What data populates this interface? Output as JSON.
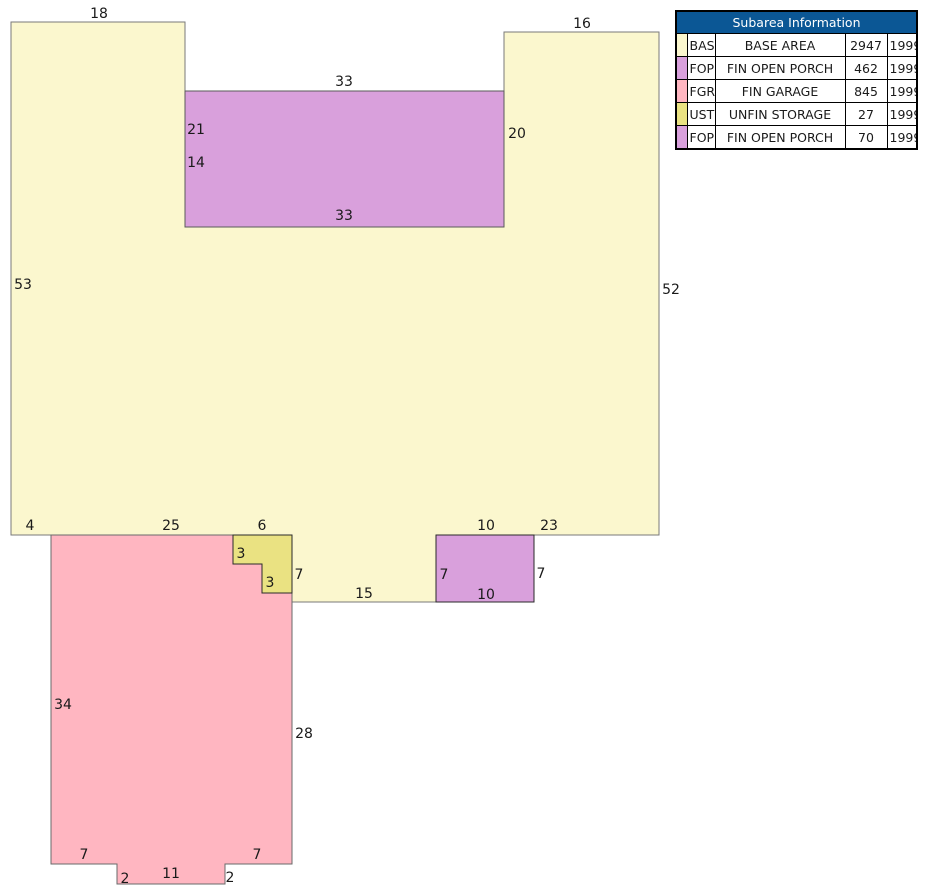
{
  "colors": {
    "background": "#ffffff",
    "table_header_bg": "#0B5795",
    "table_header_text": "#ffffff",
    "base_area_fill": "#FBF7CE",
    "fin_open_porch_fill": "#D9A0DC",
    "fin_garage_fill": "#FFB6C1",
    "unfin_storage_fill": "#EAE282",
    "outline_light": "#7a7a7a",
    "outline_dark": "#2a2a2a",
    "label_text": "#1a1a1a"
  },
  "sketch": {
    "areas": [
      {
        "name": "base-area",
        "code": "BAS",
        "color": "#FBF7CE",
        "stroke": "#7a7a7a",
        "path": "M11,22 L185,22 L185,227 L504,227 L504,32 L659,32 L659,535 L436,535 L436,602 L292,602 L292,535 L11,535 Z"
      },
      {
        "name": "fin-open-porch-462",
        "code": "FOP",
        "color": "#D9A0DC",
        "stroke": "#5a5a5a",
        "path": "M185,91 L504,91 L504,227 L185,227 Z"
      },
      {
        "name": "fin-garage",
        "code": "FGR",
        "color": "#FFB6C1",
        "stroke": "#6a6a6a",
        "path": "M51,535 L233,535 L233,564 L262,564 L262,593 L292,593 L292,864 L225,864 L225,884 L117,884 L117,864 L51,864 Z"
      },
      {
        "name": "unfin-storage",
        "code": "UST",
        "color": "#EAE282",
        "stroke": "#2a2a2a",
        "path": "M233,535 L292,535 L292,593 L262,593 L262,564 L233,564 Z"
      },
      {
        "name": "fin-open-porch-70",
        "code": "FOP",
        "color": "#D9A0DC",
        "stroke": "#2a2a2a",
        "path": "M436,535 L534,535 L534,602 L436,602 Z"
      }
    ],
    "labels": [
      {
        "text": "18",
        "x": 99,
        "y": 18
      },
      {
        "text": "16",
        "x": 582,
        "y": 28
      },
      {
        "text": "33",
        "x": 344,
        "y": 86
      },
      {
        "text": "21",
        "x": 196,
        "y": 134
      },
      {
        "text": "14",
        "x": 196,
        "y": 167
      },
      {
        "text": "20",
        "x": 517,
        "y": 138
      },
      {
        "text": "33",
        "x": 344,
        "y": 220
      },
      {
        "text": "53",
        "x": 23,
        "y": 289
      },
      {
        "text": "52",
        "x": 671,
        "y": 294
      },
      {
        "text": "4",
        "x": 30,
        "y": 530
      },
      {
        "text": "25",
        "x": 171,
        "y": 530
      },
      {
        "text": "6",
        "x": 262,
        "y": 530
      },
      {
        "text": "3",
        "x": 241,
        "y": 558
      },
      {
        "text": "3",
        "x": 270,
        "y": 587
      },
      {
        "text": "7",
        "x": 299,
        "y": 579
      },
      {
        "text": "15",
        "x": 364,
        "y": 598
      },
      {
        "text": "7",
        "x": 444,
        "y": 579
      },
      {
        "text": "10",
        "x": 486,
        "y": 530
      },
      {
        "text": "10",
        "x": 486,
        "y": 599
      },
      {
        "text": "7",
        "x": 541,
        "y": 578
      },
      {
        "text": "23",
        "x": 549,
        "y": 530
      },
      {
        "text": "34",
        "x": 63,
        "y": 709
      },
      {
        "text": "28",
        "x": 304,
        "y": 738
      },
      {
        "text": "7",
        "x": 84,
        "y": 859
      },
      {
        "text": "7",
        "x": 257,
        "y": 859
      },
      {
        "text": "2",
        "x": 125,
        "y": 883
      },
      {
        "text": "11",
        "x": 171,
        "y": 878
      },
      {
        "text": "2",
        "x": 230,
        "y": 882
      }
    ]
  },
  "table": {
    "title": "Subarea Information",
    "rows": [
      {
        "code": "BAS",
        "desc": "BASE AREA",
        "area": "2947",
        "year": "1999",
        "color": "#FBF7CE"
      },
      {
        "code": "FOP",
        "desc": "FIN OPEN PORCH",
        "area": "462",
        "year": "1999",
        "color": "#D9A0DC"
      },
      {
        "code": "FGR",
        "desc": "FIN GARAGE",
        "area": "845",
        "year": "1999",
        "color": "#FFB6C1"
      },
      {
        "code": "UST",
        "desc": "UNFIN STORAGE",
        "area": "27",
        "year": "1999",
        "color": "#EAE282"
      },
      {
        "code": "FOP",
        "desc": "FIN OPEN PORCH",
        "area": "70",
        "year": "1999",
        "color": "#D9A0DC"
      }
    ]
  }
}
